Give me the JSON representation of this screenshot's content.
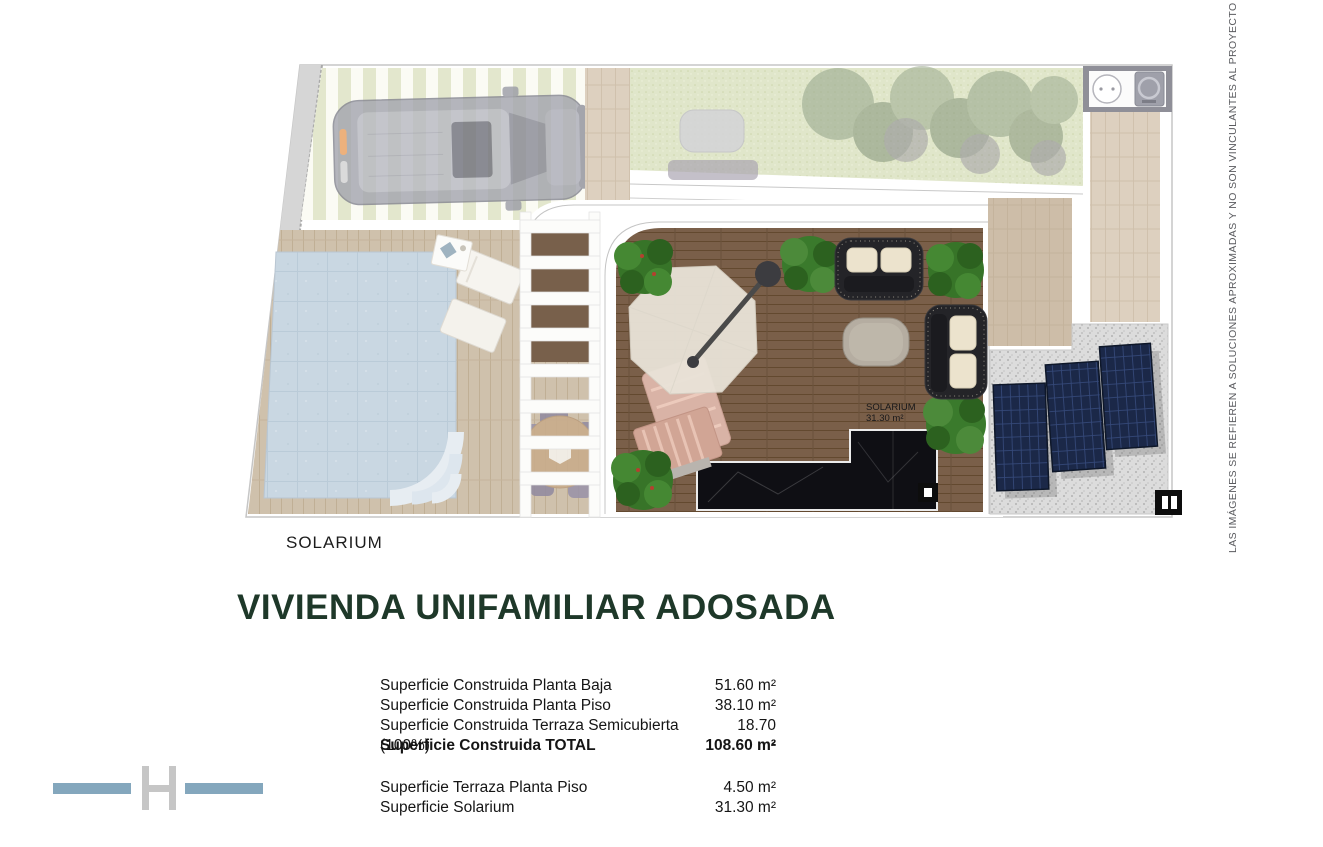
{
  "title": {
    "text": "VIVIENDA UNIFAMILIAR ADOSADA"
  },
  "plan": {
    "caption": "SOLARIUM",
    "area_label": {
      "line1": "SOLARIUM",
      "line2": "31.30 m²"
    }
  },
  "disclaimer": {
    "text": "LAS IMÁGENES SE REFIEREN A SOLUCIONES APROXIMADAS Y NO SON VINCULANTES AL PROYECTO FINAL"
  },
  "area_table": {
    "rows": [
      {
        "label": "Superficie Construida Planta Baja",
        "value": "51.60 m²"
      },
      {
        "label": "Superficie Construida Planta Piso",
        "value": "38.10 m²"
      },
      {
        "label": "Superficie Construida Terraza Semicubierta (100%)",
        "value": "18.70 m²"
      },
      {
        "label": "Superficie Construida TOTAL",
        "value": "108.60 m²"
      },
      {
        "label": "Superficie Terraza Planta Piso",
        "value": "4.50 m²"
      },
      {
        "label": "Superficie Solarium",
        "value": "31.30 m²"
      }
    ]
  },
  "logo": {
    "letter": "H"
  },
  "colors": {
    "title_green": "#1e3829",
    "logo_bars": "#84a7bd",
    "logo_letter": "#c6c6c6",
    "deck_dark_wood": "#7a5f49",
    "deck_light_wood": "#cfc1ac",
    "pool_water": "#c9d7e2",
    "lawn_green": "#e0e6ca",
    "solar_panel_blue": "#1b2848",
    "disclaimer_gray": "#5a5b5f"
  }
}
